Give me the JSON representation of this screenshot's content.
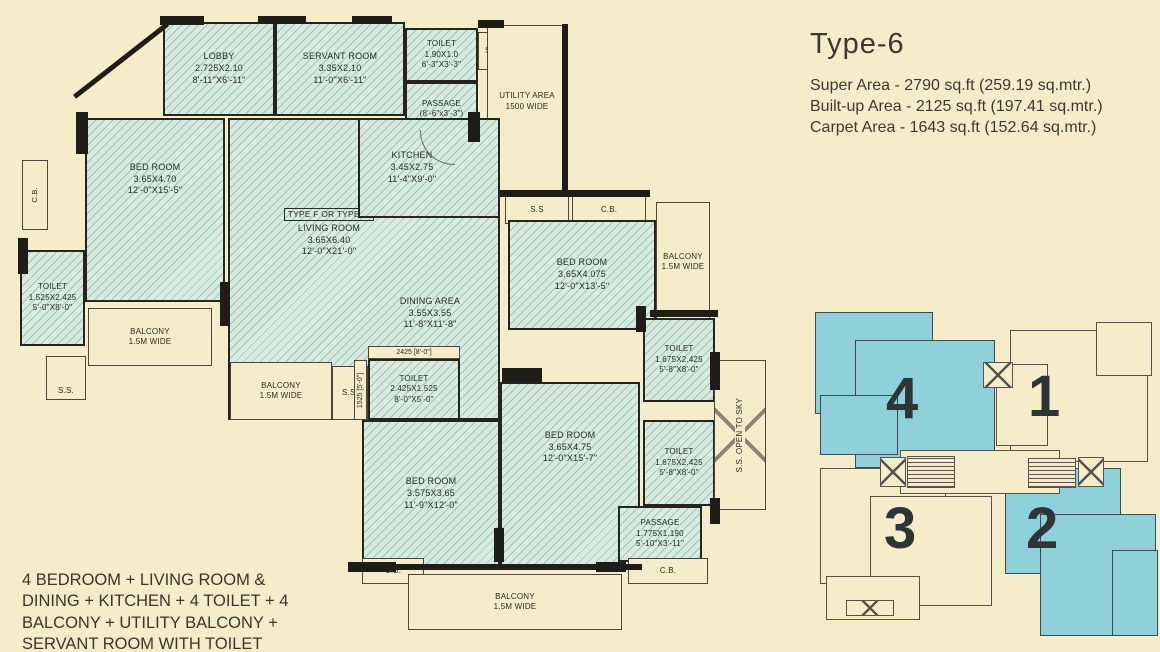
{
  "title_block": {
    "title": "Type-6",
    "super_area": "Super Area - 2790 sq.ft (259.19 sq.mtr.)",
    "built_up_area": "Built-up Area - 2125 sq.ft (197.41 sq.mtr.)",
    "carpet_area": "Carpet Area - 1643 sq.ft (152.64 sq.mtr.)"
  },
  "description": "4 BEDROOM + LIVING ROOM & DINING + KITCHEN + 4 TOILET + 4 BALCONY + UTILITY BALCONY + SERVANT ROOM WITH TOILET",
  "unit_type_tag": "TYPE F OR TYPE -6",
  "rooms": {
    "lobby": {
      "name": "LOBBY",
      "dim_m": "2.725X2.10",
      "dim_ft": "8'-11\"X6'-11\""
    },
    "servant_room": {
      "name": "SERVANT ROOM",
      "dim_m": "3.35X2.10",
      "dim_ft": "11'-0\"X6'-11\""
    },
    "toilet_servant": {
      "name": "TOILET",
      "dim_m": "1.90X1.0",
      "dim_ft": "6'-3\"X3'-3\""
    },
    "passage_top": {
      "name": "PASSAGE",
      "dim_ft": "(8'-6\"x3'-3\")"
    },
    "utility": {
      "name": "UTILITY AREA",
      "dim_ft": "1500 WIDE"
    },
    "bedroom_master": {
      "name": "BED ROOM",
      "dim_m": "3.65X4.70",
      "dim_ft": "12'-0\"X15'-5\""
    },
    "kitchen": {
      "name": "KITCHEN",
      "dim_m": "3.45X2.75",
      "dim_ft": "11'-4\"X9'-0\""
    },
    "living": {
      "name": "LIVING ROOM",
      "dim_m": "3.65X6.40",
      "dim_ft": "12'-0\"X21'-0\""
    },
    "dining": {
      "name": "DINING AREA",
      "dim_m": "3.55X3.55",
      "dim_ft": "11'-8\"X11'-8\""
    },
    "toilet_left": {
      "name": "TOILET",
      "dim_m": "1.525X2.425",
      "dim_ft": "5'-0\"X8'-0\""
    },
    "balcony_left": {
      "name": "BALCONY",
      "dim_ft": "1.5M WIDE"
    },
    "balcony_mid": {
      "name": "BALCONY",
      "dim_ft": "1.5M WIDE"
    },
    "toilet_mid": {
      "name": "TOILET",
      "dim_m": "2.425X1.525",
      "dim_ft": "8'-0\"X5'-0\"",
      "dim_top": "2425 [8'-0\"]",
      "dim_side": "1525 [5'-0\"]"
    },
    "bedroom_right1": {
      "name": "BED ROOM",
      "dim_m": "3.65X4.075",
      "dim_ft": "12'-0\"X13'-5\""
    },
    "balcony_right": {
      "name": "BALCONY",
      "dim_ft": "1.5M WIDE"
    },
    "toilet_right1": {
      "name": "TOILET",
      "dim_m": "1.675X2.425",
      "dim_ft": "5'-8\"X8'-0\""
    },
    "toilet_right2": {
      "name": "TOILET",
      "dim_m": "1.675X2.425",
      "dim_ft": "5'-8\"X8'-0\""
    },
    "bedroom_right2": {
      "name": "BED ROOM",
      "dim_m": "3.65X4.75",
      "dim_ft": "12'-0\"X15'-7\""
    },
    "bedroom_bottom": {
      "name": "BED ROOM",
      "dim_m": "3.575X3.65",
      "dim_ft": "11'-9\"X12'-0\""
    },
    "passage_bottom": {
      "name": "PASSAGE",
      "dim_m": "1.775X1.190",
      "dim_ft": "5'-10\"X3'-11\""
    },
    "balcony_bottom": {
      "name": "BALCONY",
      "dim_ft": "1.5M WIDE"
    },
    "shaft": {
      "name": "S.S. OPEN TO SKY"
    }
  },
  "labels": {
    "ss": "S.S.",
    "ss_short": "S.S",
    "cb": "C.B."
  },
  "key_plan": {
    "units": [
      {
        "number": "4",
        "highlighted": true
      },
      {
        "number": "1",
        "highlighted": false
      },
      {
        "number": "3",
        "highlighted": false
      },
      {
        "number": "2",
        "highlighted": true
      }
    ]
  },
  "colors": {
    "background": "#f5ecca",
    "hatch_fill": "#d9ebe0",
    "hatch_line": "#71a892",
    "wall": "#1f1d17",
    "highlight_unit": "#8ed1da",
    "text": "#2c2a22"
  }
}
